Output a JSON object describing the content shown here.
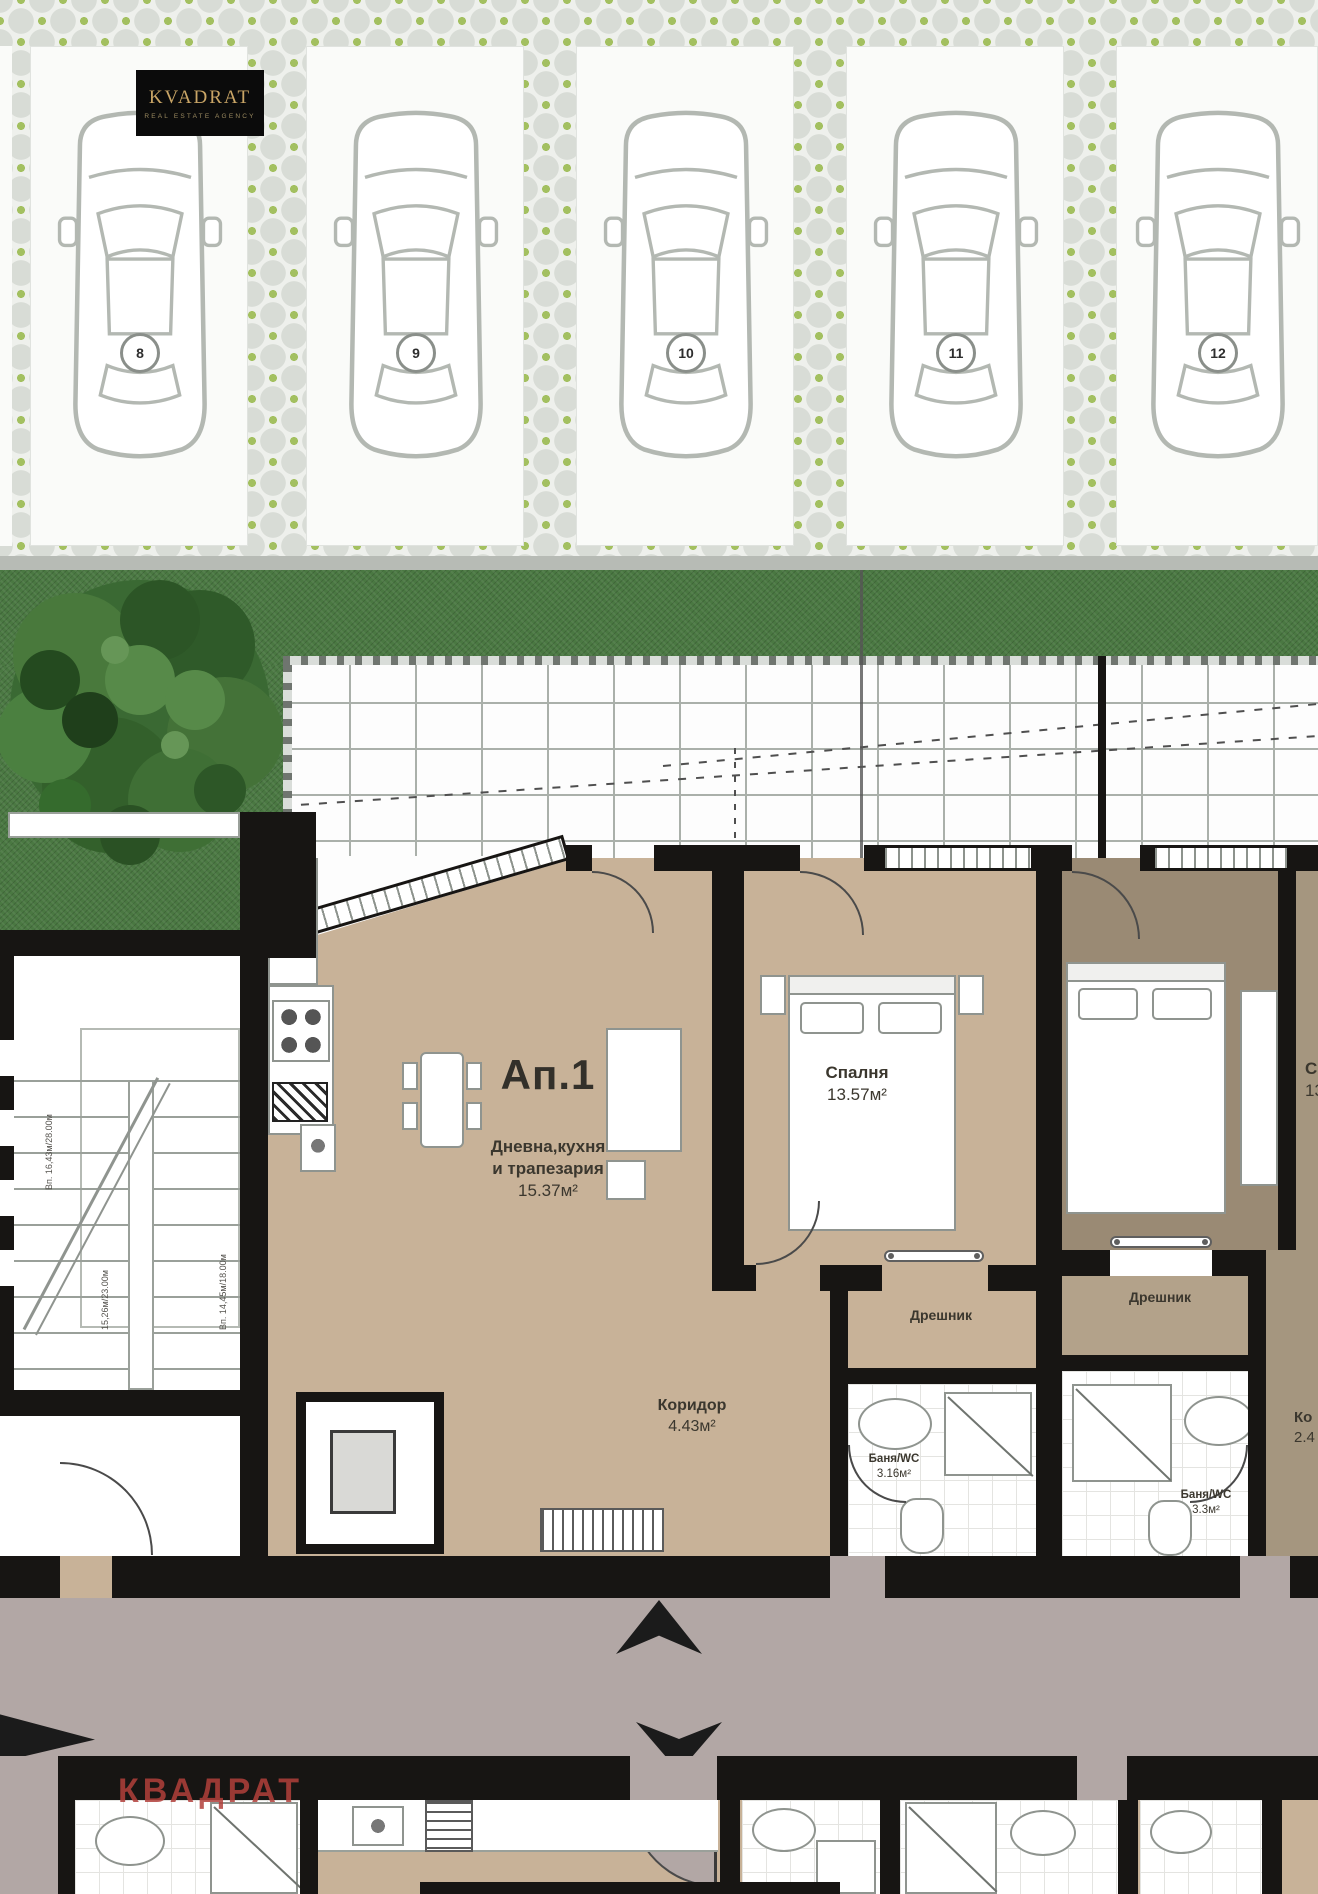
{
  "brand": {
    "logo_title": "KVADRAT",
    "logo_subtitle": "REAL ESTATE AGENCY",
    "watermark": "КВАДРАТ"
  },
  "colors": {
    "wall_black": "#171513",
    "floor_tan": "#c8b298",
    "adjacent_room_dark": "#9a8a74",
    "hallway_mauve": "#b2a7a5",
    "grass_green": "#4a7842",
    "paver_green": "#a3c060",
    "logo_gold": "#c9a566",
    "watermark_red": "#b2403b"
  },
  "parking": {
    "spots": [
      {
        "number": "8"
      },
      {
        "number": "9"
      },
      {
        "number": "10"
      },
      {
        "number": "11"
      },
      {
        "number": "12"
      }
    ]
  },
  "apartment": {
    "unit_label": "Ап.1",
    "living_name_line1": "Дневна,кухня",
    "living_name_line2": "и трапезария",
    "living_area": "15.37м²",
    "bedroom_name": "Спалня",
    "bedroom_area": "13.57м²",
    "corridor_name": "Коридор",
    "corridor_area": "4.43м²",
    "bath1_name": "Баня/WC",
    "bath1_area": "3.16м²",
    "closet1_name": "Дрешник",
    "closet2_name": "Дрешник",
    "bath2_name": "Баня/WC",
    "bath2_area": "3.3м²"
  },
  "adjacent": {
    "bedroom_partial_name": "С",
    "bedroom_partial_area": "13",
    "corridor_partial_name": "Ко",
    "corridor_partial_area": "2.4"
  },
  "stairwell": {
    "dim_label_1": "Вп. 16,43м/28.00м",
    "dim_label_2": "15,26м/23.00м",
    "dim_label_3": "Вп. 14,45м/18.00м"
  }
}
